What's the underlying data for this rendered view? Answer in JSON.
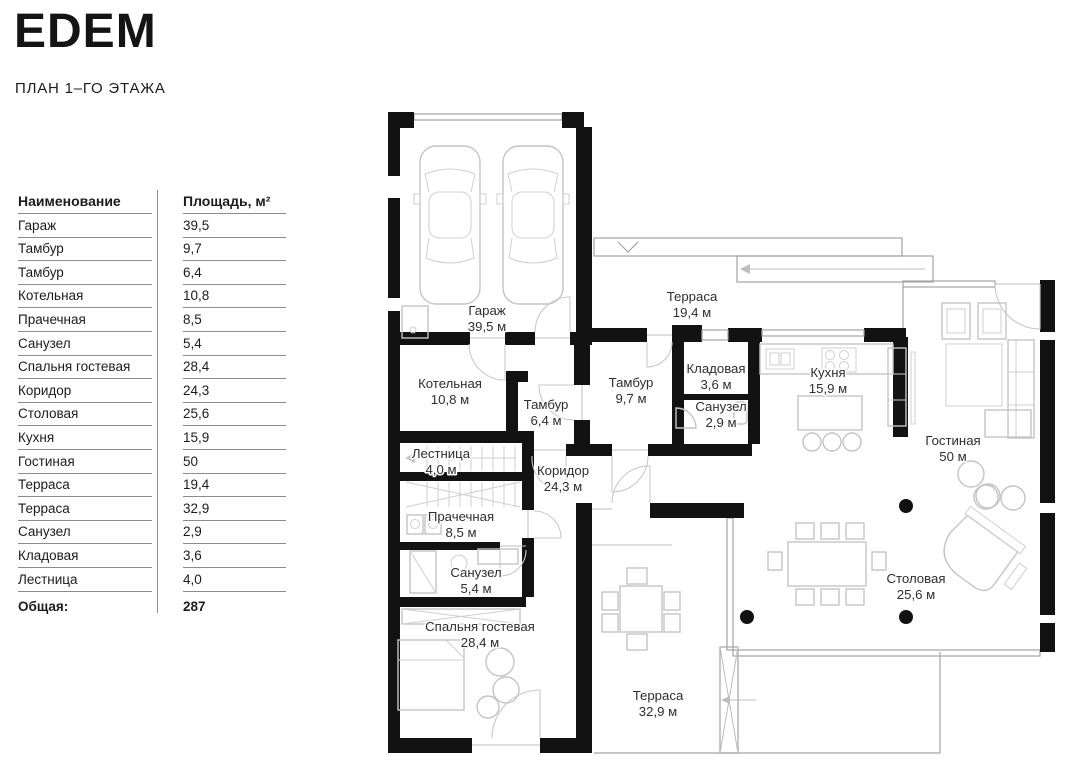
{
  "header": {
    "title": "EDEM",
    "subtitle": "ПЛАН 1–ГО ЭТАЖА"
  },
  "table": {
    "headers": [
      "Наименование",
      "Площадь, м²"
    ],
    "rows": [
      {
        "name": "Гараж",
        "area": "39,5"
      },
      {
        "name": "Тамбур",
        "area": "9,7"
      },
      {
        "name": "Тамбур",
        "area": "6,4"
      },
      {
        "name": "Котельная",
        "area": "10,8"
      },
      {
        "name": "Прачечная",
        "area": "8,5"
      },
      {
        "name": "Санузел",
        "area": "5,4"
      },
      {
        "name": "Спальня гостевая",
        "area": "28,4"
      },
      {
        "name": "Коридор",
        "area": "24,3"
      },
      {
        "name": "Столовая",
        "area": "25,6"
      },
      {
        "name": "Кухня",
        "area": "15,9"
      },
      {
        "name": "Гостиная",
        "area": "50"
      },
      {
        "name": "Терраса",
        "area": "19,4"
      },
      {
        "name": "Терраса",
        "area": "32,9"
      },
      {
        "name": "Санузел",
        "area": "2,9"
      },
      {
        "name": "Кладовая",
        "area": "3,6"
      },
      {
        "name": "Лестница",
        "area": "4,0"
      }
    ],
    "total": {
      "label": "Общая:",
      "value": "287"
    }
  },
  "plan": {
    "rooms": [
      {
        "name": "Гараж",
        "area": "39,5 м",
        "x": 487,
        "y": 315
      },
      {
        "name": "Котельная",
        "area": "10,8 м",
        "x": 450,
        "y": 388
      },
      {
        "name": "Тамбур",
        "area": "6,4 м",
        "x": 546,
        "y": 409
      },
      {
        "name": "Тамбур",
        "area": "9,7 м",
        "x": 631,
        "y": 387
      },
      {
        "name": "Терраса",
        "area": "19,4 м",
        "x": 692,
        "y": 301
      },
      {
        "name": "Кладовая",
        "area": "3,6 м",
        "x": 716,
        "y": 373
      },
      {
        "name": "Санузел",
        "area": "2,9 м",
        "x": 721,
        "y": 411
      },
      {
        "name": "Кухня",
        "area": "15,9 м",
        "x": 828,
        "y": 377
      },
      {
        "name": "Гостиная",
        "area": "50 м",
        "x": 953,
        "y": 445
      },
      {
        "name": "Лестница",
        "area": "4,0 м",
        "x": 441,
        "y": 458
      },
      {
        "name": "Коридор",
        "area": "24,3 м",
        "x": 563,
        "y": 475
      },
      {
        "name": "Прачечная",
        "area": "8,5 м",
        "x": 461,
        "y": 521
      },
      {
        "name": "Санузел",
        "area": "5,4 м",
        "x": 476,
        "y": 577
      },
      {
        "name": "Спальня гостевая",
        "area": "28,4 м",
        "x": 480,
        "y": 631
      },
      {
        "name": "Столовая",
        "area": "25,6 м",
        "x": 916,
        "y": 583
      },
      {
        "name": "Терраса",
        "area": "32,9 м",
        "x": 658,
        "y": 700
      }
    ],
    "colors": {
      "wall": "#121212",
      "furniture_line": "#c4c4c4",
      "label_text": "#2e2e2e"
    }
  }
}
